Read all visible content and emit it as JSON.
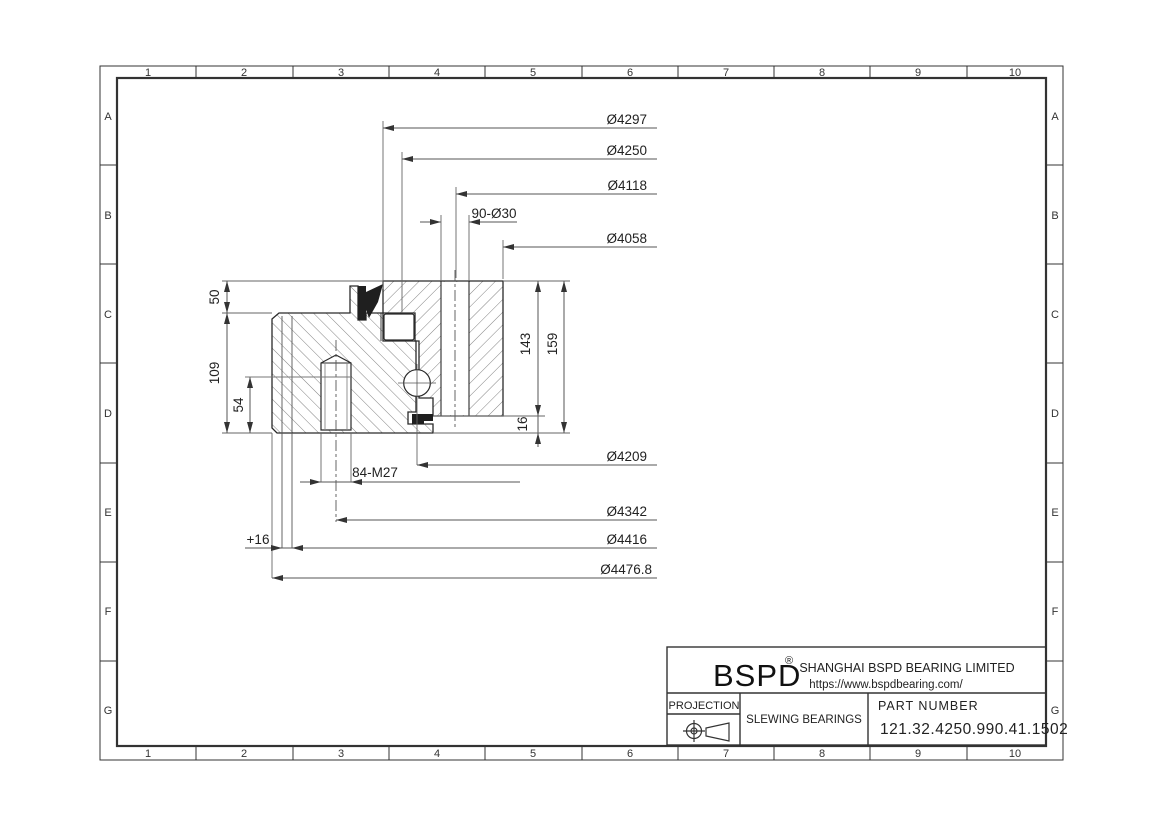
{
  "grid": {
    "cols": [
      "1",
      "2",
      "3",
      "4",
      "5",
      "6",
      "7",
      "8",
      "9",
      "10"
    ],
    "rows": [
      "A",
      "B",
      "C",
      "D",
      "E",
      "F",
      "G"
    ]
  },
  "dims": {
    "d4297": "Ø4297",
    "d4250": "Ø4250",
    "d4118": "Ø4118",
    "holes_outer": "90-Ø30",
    "d4058": "Ø4058",
    "d4209": "Ø4209",
    "holes_inner": "84-M27",
    "d4342": "Ø4342",
    "plus16": "+16",
    "d4416": "Ø4416",
    "d4476": "Ø4476.8",
    "v50": "50",
    "v109": "109",
    "v54": "54",
    "v143": "143",
    "v159": "159",
    "v16": "16"
  },
  "title_block": {
    "logo": "BSPD",
    "reg": "®",
    "company": "SHANGHAI BSPD BEARING LIMITED",
    "website": "https://www.bspdbearing.com/",
    "projection_label": "PROJECTION",
    "product": "SLEWING BEARINGS",
    "part_number_label": "PART NUMBER",
    "part_number": "121.32.4250.990.41.1502"
  },
  "colors": {
    "line": "#333333",
    "dim_line": "#555555",
    "hatch": "#757575",
    "seal": "#1f1f1f",
    "background": "#ffffff"
  }
}
